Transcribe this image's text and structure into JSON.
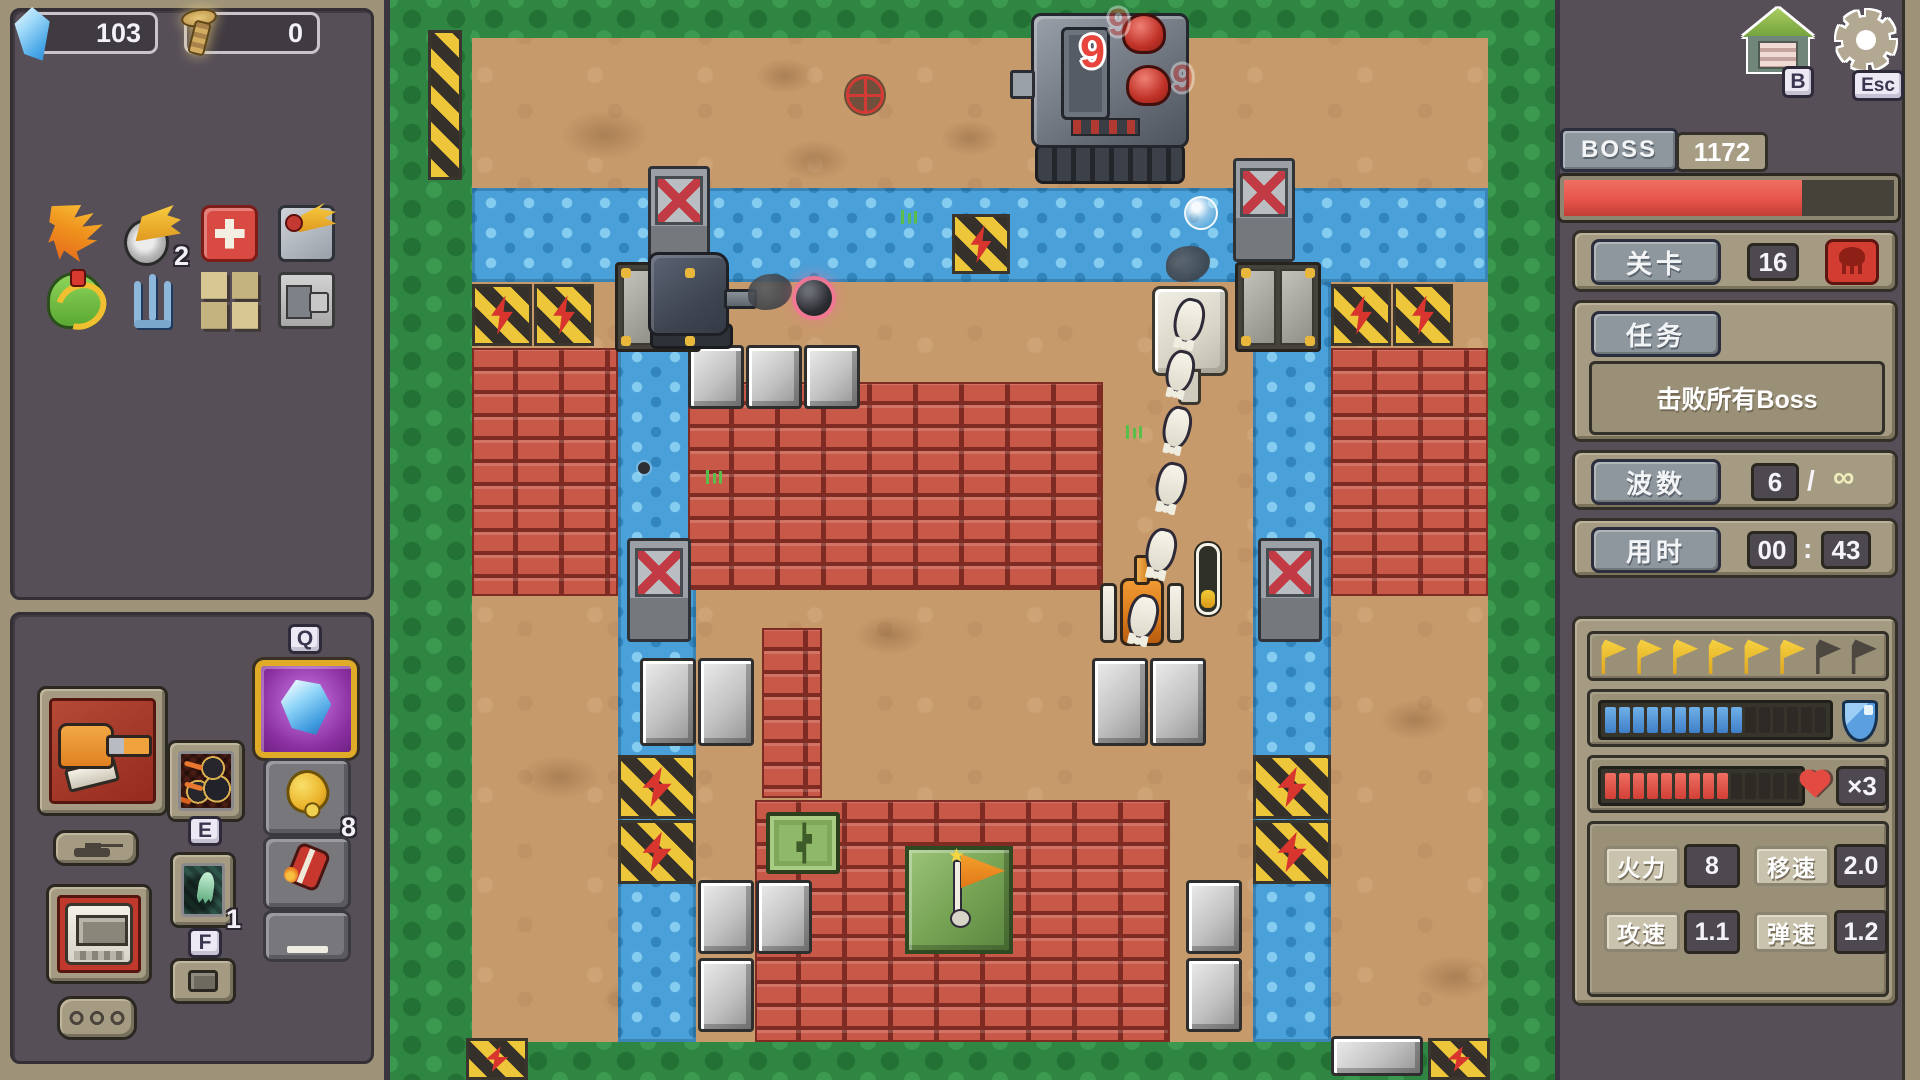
{
  "resources": {
    "crystal_count": "103",
    "bolt_count": "0"
  },
  "hotkeys": {
    "q": "Q",
    "e": "E",
    "f": "F",
    "b": "B",
    "esc": "Esc"
  },
  "inventory": {
    "items": [
      {
        "id": "flame",
        "name": "flame-banner-item",
        "count": ""
      },
      {
        "id": "wing",
        "name": "winged-wheel-item",
        "count": "2"
      },
      {
        "id": "cross",
        "name": "red-block-item",
        "count": ""
      },
      {
        "id": "turret",
        "name": "turret-part-item",
        "count": ""
      },
      {
        "id": "rover",
        "name": "green-rover-item",
        "count": ""
      },
      {
        "id": "trident",
        "name": "trident-item",
        "count": ""
      },
      {
        "id": "tiles",
        "name": "tile-blocks-item",
        "count": ""
      },
      {
        "id": "module",
        "name": "gray-module-item",
        "count": ""
      }
    ]
  },
  "loadout": {
    "bell_count": "8",
    "ghost_count": "1"
  },
  "boss": {
    "label": "BOSS",
    "hp": "1172",
    "hp_pct": 72
  },
  "level": {
    "label": "关卡",
    "value": "16"
  },
  "mission": {
    "label": "任务",
    "text": "击败所有Boss"
  },
  "wave": {
    "label": "波数",
    "current": "6",
    "separator": "/",
    "total": "∞"
  },
  "timer": {
    "label": "用时",
    "minutes": "00",
    "colon": ":",
    "seconds": "43"
  },
  "progress": {
    "flags_total": 8,
    "flags_lit": 6,
    "shield_total": 16,
    "shield_filled": 10,
    "health_total": 14,
    "health_filled": 9,
    "lives": "×3"
  },
  "stats": [
    {
      "label": "火力",
      "value": "8"
    },
    {
      "label": "移速",
      "value": "2.0"
    },
    {
      "label": "攻速",
      "value": "1.1"
    },
    {
      "label": "弹速",
      "value": "1.2"
    }
  ],
  "colors": {
    "accent_red": "#e8544c",
    "hud_blue": "#4a90d8",
    "flag_yellow": "#f2c937",
    "panel_tan": "#a59b82",
    "panel_dark": "#564f58"
  },
  "map": {
    "origin_x": 390,
    "entities": [
      {
        "type": "patch",
        "x": 560,
        "y": 110,
        "w": 90,
        "h": 50
      },
      {
        "type": "patch",
        "x": 780,
        "y": 140,
        "w": 70,
        "h": 40
      },
      {
        "type": "patch",
        "x": 940,
        "y": 120,
        "w": 60,
        "h": 36
      },
      {
        "type": "patch",
        "x": 755,
        "y": 58,
        "w": 60,
        "h": 36
      },
      {
        "type": "patch",
        "x": 660,
        "y": 455,
        "w": 80,
        "h": 46
      },
      {
        "type": "patch",
        "x": 975,
        "y": 515,
        "w": 90,
        "h": 50
      },
      {
        "type": "patch",
        "x": 855,
        "y": 615,
        "w": 70,
        "h": 40
      },
      {
        "type": "patch",
        "x": 520,
        "y": 755,
        "w": 80,
        "h": 44
      },
      {
        "type": "patch",
        "x": 1095,
        "y": 815,
        "w": 80,
        "h": 46
      },
      {
        "type": "patch",
        "x": 600,
        "y": 975,
        "w": 90,
        "h": 50
      },
      {
        "type": "patch",
        "x": 1380,
        "y": 700,
        "w": 70,
        "h": 40
      },
      {
        "type": "patch",
        "x": 1415,
        "y": 955,
        "w": 80,
        "h": 44
      },
      {
        "type": "patch",
        "x": 490,
        "y": 420,
        "w": 60,
        "h": 40
      },
      {
        "type": "grass",
        "x": 390,
        "y": 0,
        "w": 82,
        "h": 1080
      },
      {
        "type": "grass",
        "x": 1488,
        "y": 0,
        "w": 67,
        "h": 1080
      },
      {
        "type": "grass",
        "x": 472,
        "y": 0,
        "w": 1016,
        "h": 38
      },
      {
        "type": "grass",
        "x": 472,
        "y": 1042,
        "w": 1016,
        "h": 38
      },
      {
        "type": "hazard",
        "x": 428,
        "y": 30,
        "w": 34,
        "h": 150
      },
      {
        "type": "water",
        "x": 472,
        "y": 188,
        "w": 1016,
        "h": 94
      },
      {
        "type": "water",
        "x": 618,
        "y": 282,
        "w": 78,
        "h": 760
      },
      {
        "type": "water",
        "x": 1253,
        "y": 282,
        "w": 78,
        "h": 760
      },
      {
        "type": "brick",
        "x": 472,
        "y": 348,
        "w": 146,
        "h": 248
      },
      {
        "type": "brick",
        "x": 1331,
        "y": 348,
        "w": 157,
        "h": 248
      },
      {
        "type": "brick",
        "x": 688,
        "y": 382,
        "w": 415,
        "h": 208
      },
      {
        "type": "brick",
        "x": 762,
        "y": 628,
        "w": 60,
        "h": 170
      },
      {
        "type": "brick",
        "x": 755,
        "y": 800,
        "w": 415,
        "h": 242
      },
      {
        "type": "stone",
        "x": 688,
        "y": 345,
        "w": 56,
        "h": 64
      },
      {
        "type": "stone",
        "x": 746,
        "y": 345,
        "w": 56,
        "h": 64
      },
      {
        "type": "stone",
        "x": 804,
        "y": 345,
        "w": 56,
        "h": 64
      },
      {
        "type": "stone",
        "x": 640,
        "y": 658,
        "w": 56,
        "h": 88
      },
      {
        "type": "stone",
        "x": 698,
        "y": 658,
        "w": 56,
        "h": 88
      },
      {
        "type": "stone",
        "x": 1092,
        "y": 658,
        "w": 56,
        "h": 88
      },
      {
        "type": "stone",
        "x": 1150,
        "y": 658,
        "w": 56,
        "h": 88
      },
      {
        "type": "stone",
        "x": 698,
        "y": 880,
        "w": 56,
        "h": 74
      },
      {
        "type": "stone",
        "x": 756,
        "y": 880,
        "w": 56,
        "h": 74
      },
      {
        "type": "stone",
        "x": 698,
        "y": 958,
        "w": 56,
        "h": 74
      },
      {
        "type": "stone",
        "x": 1186,
        "y": 880,
        "w": 56,
        "h": 74
      },
      {
        "type": "stone",
        "x": 1186,
        "y": 958,
        "w": 56,
        "h": 74
      },
      {
        "type": "stone",
        "x": 1331,
        "y": 1036,
        "w": 92,
        "h": 40
      },
      {
        "type": "hazard",
        "x": 952,
        "y": 214,
        "w": 58,
        "h": 60
      },
      {
        "type": "hazard",
        "x": 472,
        "y": 284,
        "w": 60,
        "h": 62
      },
      {
        "type": "hazard",
        "x": 534,
        "y": 284,
        "w": 60,
        "h": 62
      },
      {
        "type": "hazard",
        "x": 1331,
        "y": 284,
        "w": 60,
        "h": 62
      },
      {
        "type": "hazard",
        "x": 1393,
        "y": 284,
        "w": 60,
        "h": 62
      },
      {
        "type": "hazard",
        "x": 618,
        "y": 755,
        "w": 78,
        "h": 64
      },
      {
        "type": "hazard",
        "x": 618,
        "y": 820,
        "w": 78,
        "h": 64
      },
      {
        "type": "hazard",
        "x": 1253,
        "y": 755,
        "w": 78,
        "h": 64
      },
      {
        "type": "hazard",
        "x": 1253,
        "y": 820,
        "w": 78,
        "h": 64
      },
      {
        "type": "hazard",
        "x": 466,
        "y": 1038,
        "w": 62,
        "h": 42
      },
      {
        "type": "hazard",
        "x": 1428,
        "y": 1038,
        "w": 62,
        "h": 42
      },
      {
        "type": "door",
        "x": 615,
        "y": 262,
        "w": 86,
        "h": 90
      },
      {
        "type": "door",
        "x": 1235,
        "y": 262,
        "w": 86,
        "h": 90
      },
      {
        "type": "gate-x",
        "x": 648,
        "y": 166,
        "w": 62,
        "h": 104
      },
      {
        "type": "gate-x",
        "x": 1233,
        "y": 158,
        "w": 62,
        "h": 104
      },
      {
        "type": "gate-x",
        "x": 627,
        "y": 538,
        "w": 64,
        "h": 104
      },
      {
        "type": "gate-x",
        "x": 1258,
        "y": 538,
        "w": 64,
        "h": 104
      },
      {
        "type": "tuft",
        "x": 1125,
        "y": 425,
        "w": 18,
        "h": 14
      },
      {
        "type": "tuft",
        "x": 705,
        "y": 470,
        "w": 18,
        "h": 14
      },
      {
        "type": "tuft",
        "x": 900,
        "y": 210,
        "w": 18,
        "h": 14
      },
      {
        "type": "crate",
        "x": 766,
        "y": 812,
        "w": 74,
        "h": 62
      },
      {
        "type": "flag-base",
        "x": 905,
        "y": 846,
        "w": 108,
        "h": 108
      },
      {
        "type": "boss-tank",
        "x": 1028,
        "y": 6,
        "w": 164,
        "h": 178
      },
      {
        "type": "enemy-tank",
        "x": 648,
        "y": 252,
        "w": 104,
        "h": 98
      },
      {
        "type": "white-tank",
        "x": 1152,
        "y": 286,
        "w": 76,
        "h": 112
      },
      {
        "type": "player-tank",
        "x": 1100,
        "y": 560,
        "w": 84,
        "h": 90
      },
      {
        "type": "smoke",
        "x": 748,
        "y": 274,
        "w": 44,
        "h": 36
      },
      {
        "type": "smoke",
        "x": 1166,
        "y": 246,
        "w": 44,
        "h": 36
      },
      {
        "type": "bomb",
        "x": 796,
        "y": 280,
        "w": 36,
        "h": 36
      },
      {
        "type": "pellet",
        "x": 638,
        "y": 462,
        "w": 12,
        "h": 12
      },
      {
        "type": "bullet",
        "x": 1128,
        "y": 594,
        "w": 30,
        "h": 46
      },
      {
        "type": "bullet",
        "x": 1146,
        "y": 528,
        "w": 30,
        "h": 46
      },
      {
        "type": "bullet",
        "x": 1156,
        "y": 462,
        "w": 30,
        "h": 46
      },
      {
        "type": "bullet",
        "x": 1163,
        "y": 406,
        "w": 28,
        "h": 44
      },
      {
        "type": "bullet",
        "x": 1166,
        "y": 350,
        "w": 28,
        "h": 44
      },
      {
        "type": "bullet",
        "x": 1174,
        "y": 298,
        "w": 30,
        "h": 46
      },
      {
        "type": "gauge",
        "x": 1196,
        "y": 543,
        "w": 24,
        "h": 72
      },
      {
        "type": "bubble",
        "x": 1184,
        "y": 196,
        "w": 34,
        "h": 34
      },
      {
        "type": "crosshair",
        "x": 846,
        "y": 76,
        "w": 38,
        "h": 38
      }
    ],
    "damage_numbers": [
      {
        "text": "9",
        "x": 1080,
        "y": 26,
        "faded": false
      },
      {
        "text": "9",
        "x": 1108,
        "y": 2,
        "faded": true
      },
      {
        "text": "9",
        "x": 1172,
        "y": 58,
        "faded": true
      }
    ]
  }
}
